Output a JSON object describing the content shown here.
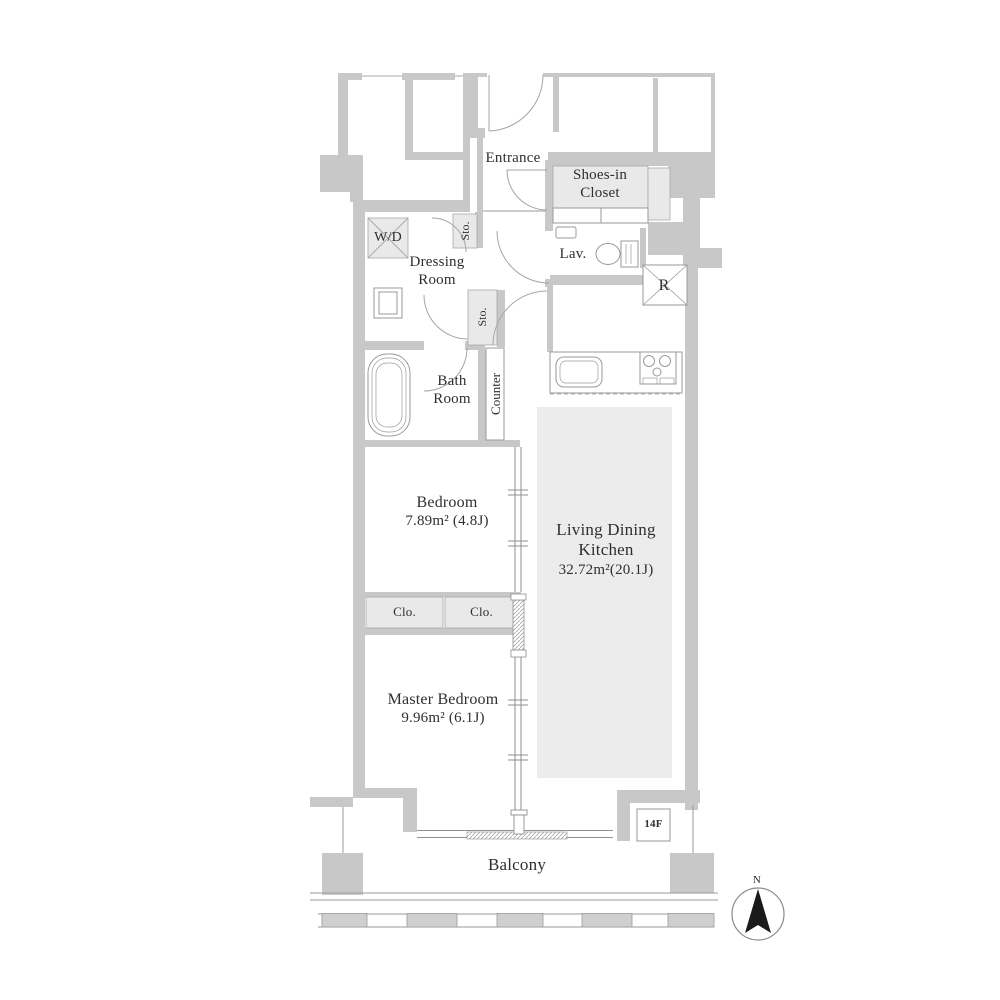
{
  "plan": {
    "entrance": {
      "label": "Entrance"
    },
    "shoes_in_closet": {
      "line1": "Shoes-in",
      "line2": "Closet"
    },
    "washer_dryer": {
      "label": "W/D"
    },
    "storage_upper": {
      "label": "Sto."
    },
    "storage_lower": {
      "label": "Sto."
    },
    "dressing_room": {
      "line1": "Dressing",
      "line2": "Room"
    },
    "lavatory": {
      "label": "Lav."
    },
    "refrigerator_space": {
      "label": "R"
    },
    "bath_room": {
      "line1": "Bath",
      "line2": "Room"
    },
    "counter": {
      "label": "Counter"
    },
    "bedroom": {
      "label": "Bedroom",
      "area": "7.89m² (4.8J)"
    },
    "living_dining_kitchen": {
      "line1": "Living Dining",
      "line2": "Kitchen",
      "area": "32.72m²(20.1J)"
    },
    "closet_left": {
      "label": "Clo."
    },
    "closet_right": {
      "label": "Clo."
    },
    "master_bedroom": {
      "label": "Master Bedroom",
      "area": "9.96m² (6.1J)"
    },
    "balcony": {
      "label": "Balcony"
    },
    "floor_marker": {
      "label": "14F"
    },
    "compass": {
      "north": "N"
    }
  },
  "colors": {
    "wall": "#c8c8c8",
    "room_fill": "#ffffff",
    "closet_fill": "#e9e9e9",
    "rug_fill": "#ececec",
    "thin_line": "#8f8f8f",
    "fixture_line": "#9a9a9a",
    "text": "#2f2f2f"
  }
}
